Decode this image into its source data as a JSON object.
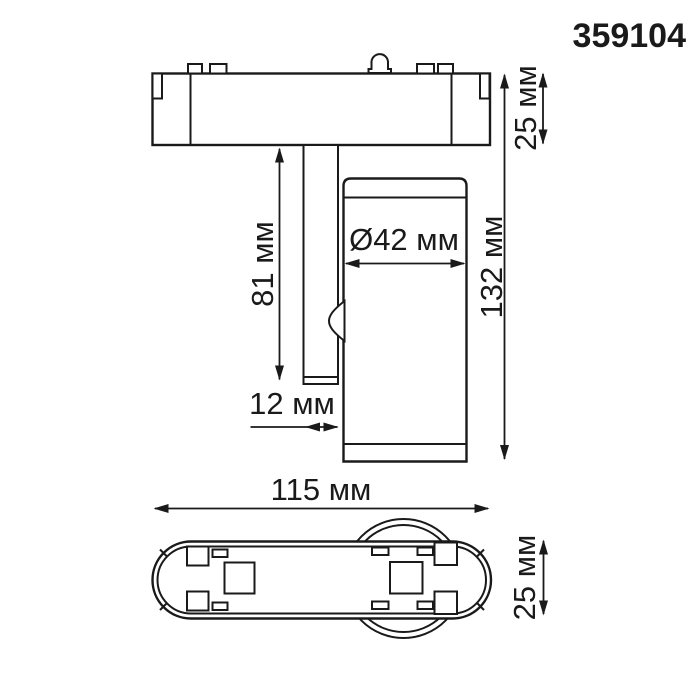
{
  "product_code": "359104",
  "colors": {
    "line_color": "#1a1a1a",
    "background": "#ffffff"
  },
  "side_view": {
    "dim_track_height": "25 мм",
    "dim_stem_length": "81 мм",
    "dim_head_diameter": "Ø42 мм",
    "dim_overall_height": "132 мм",
    "dim_stem_width": "12 мм"
  },
  "bottom_view": {
    "dim_base_length": "115 мм",
    "dim_base_width": "25 мм"
  }
}
